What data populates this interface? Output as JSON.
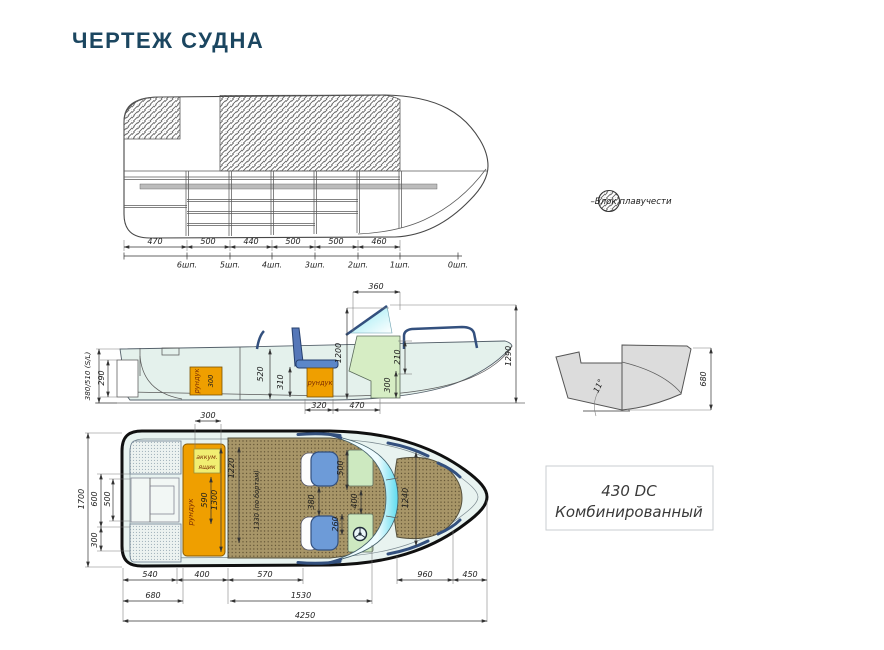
{
  "title": "ЧЕРТЕЖ СУДНА",
  "legend": {
    "label": "–Блок плавучести"
  },
  "model_box": {
    "line1": "430 DC",
    "line2": "Комбинированный"
  },
  "top_view": {
    "dims": [
      "470",
      "500",
      "440",
      "500",
      "500",
      "460"
    ],
    "frames": [
      "6шп.",
      "5шп.",
      "4шп.",
      "3шп.",
      "2шп.",
      "1шп.",
      "0шп."
    ]
  },
  "side_view": {
    "height_label": "380/510 (S/L)",
    "dim_motor": "290",
    "locker1_label": "рундук",
    "locker1_dim": "300",
    "dim_depth": "520",
    "locker2_label": "рундук",
    "dim_locker2": "310",
    "dim_console_h": "1200",
    "dim_windshield": "360",
    "dim_gunwale": "210",
    "dim_console_d": "300",
    "dim_overall_h": "1290",
    "dim_locker_len": "320",
    "dim_console_len": "470"
  },
  "transom_view": {
    "dim_height": "680",
    "deadrise": "11°"
  },
  "plan_view": {
    "dim_beam": "1700",
    "dim_stern600": "600",
    "dim_stern500": "500",
    "dim_stern300": "300",
    "dim_battery": "300",
    "battery_line1": "аккум.",
    "battery_line2": "ящик",
    "locker_label": "рундук",
    "dim_locker590": "590",
    "dim_locker1300": "1300",
    "dim_1220": "1220",
    "cockpit_width": "1330 (по бортам)",
    "dim_seats_gap": "380",
    "dim_console500": "500",
    "dim_consoles_gap": "400",
    "dim_console260": "260",
    "dim_bow": "1240",
    "bottom_row1": [
      "540",
      "400",
      "570",
      "960",
      "450"
    ],
    "bottom_row2": [
      "680",
      "1530"
    ],
    "dim_overall": "4250"
  }
}
